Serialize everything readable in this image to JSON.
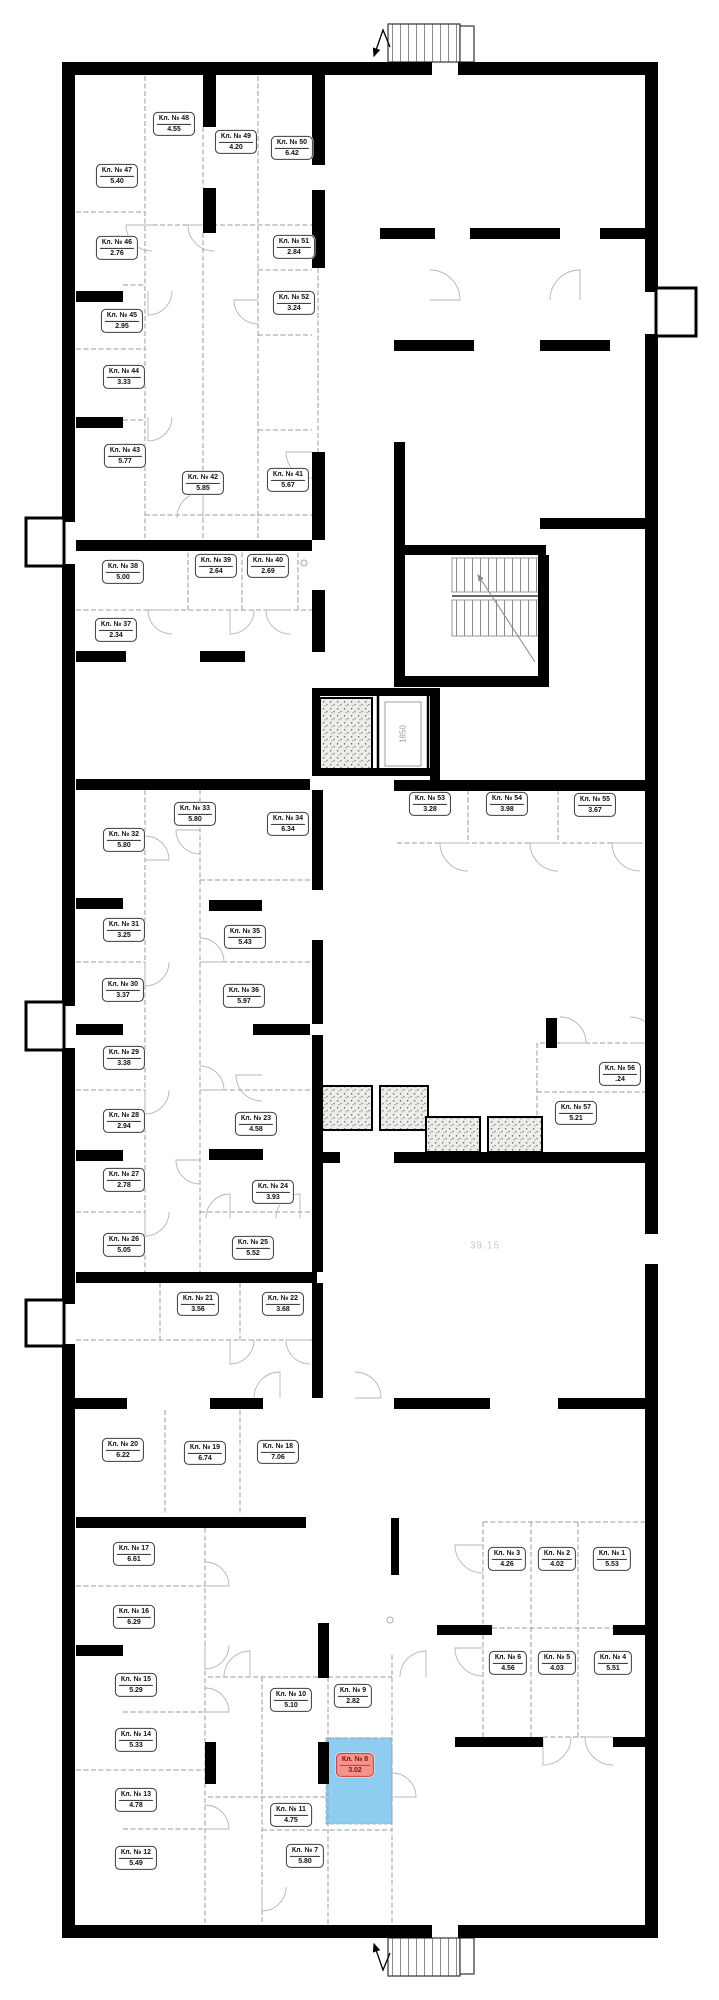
{
  "plan": {
    "wall_color": "#000000",
    "partition_color": "#9b9b9b",
    "highlight": {
      "room_fill": "#8ecdf0",
      "label_bg": "#f4928d",
      "label_border": "#cf3a31",
      "label_text": "#821313",
      "rect": [
        326,
        1738,
        66,
        86
      ]
    },
    "annotations": {
      "area_total": "39.15",
      "elevator_size": "1850"
    }
  },
  "rooms": [
    {
      "num": 1,
      "label": "Кл. № 1",
      "area": "5.53",
      "x": 612,
      "y": 1559,
      "highlighted": false
    },
    {
      "num": 2,
      "label": "Кл. № 2",
      "area": "4.02",
      "x": 557,
      "y": 1559,
      "highlighted": false
    },
    {
      "num": 3,
      "label": "Кл. № 3",
      "area": "4.26",
      "x": 507,
      "y": 1559,
      "highlighted": false
    },
    {
      "num": 4,
      "label": "Кл. № 4",
      "area": "5.51",
      "x": 613,
      "y": 1663,
      "highlighted": false
    },
    {
      "num": 5,
      "label": "Кл. № 5",
      "area": "4.03",
      "x": 557,
      "y": 1663,
      "highlighted": false
    },
    {
      "num": 6,
      "label": "Кл. № 6",
      "area": "4.56",
      "x": 508,
      "y": 1663,
      "highlighted": false
    },
    {
      "num": 7,
      "label": "Кл. № 7",
      "area": "5.80",
      "x": 305,
      "y": 1856,
      "highlighted": false
    },
    {
      "num": 8,
      "label": "Кл. № 8",
      "area": "3.02",
      "x": 355,
      "y": 1765,
      "highlighted": true
    },
    {
      "num": 9,
      "label": "Кл. № 9",
      "area": "2.82",
      "x": 353,
      "y": 1696,
      "highlighted": false
    },
    {
      "num": 10,
      "label": "Кл. № 10",
      "area": "5.10",
      "x": 291,
      "y": 1700,
      "highlighted": false
    },
    {
      "num": 11,
      "label": "Кл. № 11",
      "area": "4.75",
      "x": 291,
      "y": 1815,
      "highlighted": false
    },
    {
      "num": 12,
      "label": "Кл. № 12",
      "area": "5.49",
      "x": 136,
      "y": 1858,
      "highlighted": false
    },
    {
      "num": 13,
      "label": "Кл. № 13",
      "area": "4.78",
      "x": 136,
      "y": 1800,
      "highlighted": false
    },
    {
      "num": 14,
      "label": "Кл. № 14",
      "area": "5.33",
      "x": 136,
      "y": 1740,
      "highlighted": false
    },
    {
      "num": 15,
      "label": "Кл. № 15",
      "area": "5.29",
      "x": 136,
      "y": 1685,
      "highlighted": false
    },
    {
      "num": 16,
      "label": "Кл. № 16",
      "area": "6.29",
      "x": 134,
      "y": 1617,
      "highlighted": false
    },
    {
      "num": 17,
      "label": "Кл. № 17",
      "area": "6.61",
      "x": 134,
      "y": 1554,
      "highlighted": false
    },
    {
      "num": 18,
      "label": "Кл. № 18",
      "area": "7.06",
      "x": 278,
      "y": 1452,
      "highlighted": false
    },
    {
      "num": 19,
      "label": "Кл. № 19",
      "area": "6.74",
      "x": 205,
      "y": 1453,
      "highlighted": false
    },
    {
      "num": 20,
      "label": "Кл. № 20",
      "area": "6.22",
      "x": 123,
      "y": 1450,
      "highlighted": false
    },
    {
      "num": 21,
      "label": "Кл. № 21",
      "area": "3.56",
      "x": 198,
      "y": 1304,
      "highlighted": false
    },
    {
      "num": 22,
      "label": "Кл. № 22",
      "area": "3.68",
      "x": 283,
      "y": 1304,
      "highlighted": false
    },
    {
      "num": 23,
      "label": "Кл. № 23",
      "area": "4.58",
      "x": 256,
      "y": 1124,
      "highlighted": false
    },
    {
      "num": 24,
      "label": "Кл. № 24",
      "area": "3.93",
      "x": 273,
      "y": 1192,
      "highlighted": false
    },
    {
      "num": 25,
      "label": "Кл. № 25",
      "area": "5.52",
      "x": 253,
      "y": 1248,
      "highlighted": false
    },
    {
      "num": 26,
      "label": "Кл. № 26",
      "area": "5.05",
      "x": 124,
      "y": 1245,
      "highlighted": false
    },
    {
      "num": 27,
      "label": "Кл. № 27",
      "area": "2.78",
      "x": 124,
      "y": 1180,
      "highlighted": false
    },
    {
      "num": 28,
      "label": "Кл. № 28",
      "area": "2.94",
      "x": 124,
      "y": 1121,
      "highlighted": false
    },
    {
      "num": 29,
      "label": "Кл. № 29",
      "area": "3.38",
      "x": 124,
      "y": 1058,
      "highlighted": false
    },
    {
      "num": 30,
      "label": "Кл. № 30",
      "area": "3.37",
      "x": 123,
      "y": 990,
      "highlighted": false
    },
    {
      "num": 31,
      "label": "Кл. № 31",
      "area": "3.25",
      "x": 124,
      "y": 930,
      "highlighted": false
    },
    {
      "num": 32,
      "label": "Кл. № 32",
      "area": "5.80",
      "x": 124,
      "y": 840,
      "highlighted": false
    },
    {
      "num": 33,
      "label": "Кл. № 33",
      "area": "5.80",
      "x": 195,
      "y": 814,
      "highlighted": false
    },
    {
      "num": 34,
      "label": "Кл. № 34",
      "area": "6.34",
      "x": 288,
      "y": 824,
      "highlighted": false
    },
    {
      "num": 35,
      "label": "Кл. № 35",
      "area": "5.43",
      "x": 245,
      "y": 937,
      "highlighted": false
    },
    {
      "num": 36,
      "label": "Кл. № 36",
      "area": "5.97",
      "x": 244,
      "y": 996,
      "highlighted": false
    },
    {
      "num": 37,
      "label": "Кл. № 37",
      "area": "2.34",
      "x": 116,
      "y": 630,
      "highlighted": false
    },
    {
      "num": 38,
      "label": "Кл. № 38",
      "area": "5.00",
      "x": 123,
      "y": 572,
      "highlighted": false
    },
    {
      "num": 39,
      "label": "Кл. № 39",
      "area": "2.64",
      "x": 216,
      "y": 566,
      "highlighted": false
    },
    {
      "num": 40,
      "label": "Кл. № 40",
      "area": "2.69",
      "x": 268,
      "y": 566,
      "highlighted": false
    },
    {
      "num": 41,
      "label": "Кл. № 41",
      "area": "5.67",
      "x": 288,
      "y": 480,
      "highlighted": false
    },
    {
      "num": 42,
      "label": "Кл. № 42",
      "area": "5.85",
      "x": 203,
      "y": 483,
      "highlighted": false
    },
    {
      "num": 43,
      "label": "Кл. № 43",
      "area": "5.77",
      "x": 125,
      "y": 456,
      "highlighted": false
    },
    {
      "num": 44,
      "label": "Кл. № 44",
      "area": "3.33",
      "x": 124,
      "y": 377,
      "highlighted": false
    },
    {
      "num": 45,
      "label": "Кл. № 45",
      "area": "2.95",
      "x": 122,
      "y": 321,
      "highlighted": false
    },
    {
      "num": 46,
      "label": "Кл. № 46",
      "area": "2.76",
      "x": 117,
      "y": 248,
      "highlighted": false
    },
    {
      "num": 47,
      "label": "Кл. № 47",
      "area": "5.40",
      "x": 117,
      "y": 176,
      "highlighted": false
    },
    {
      "num": 48,
      "label": "Кл. № 48",
      "area": "4.55",
      "x": 174,
      "y": 124,
      "highlighted": false
    },
    {
      "num": 49,
      "label": "Кл. № 49",
      "area": "4.20",
      "x": 236,
      "y": 142,
      "highlighted": false
    },
    {
      "num": 50,
      "label": "Кл. № 50",
      "area": "6.42",
      "x": 292,
      "y": 148,
      "highlighted": false
    },
    {
      "num": 51,
      "label": "Кл. № 51",
      "area": "2.84",
      "x": 294,
      "y": 247,
      "highlighted": false
    },
    {
      "num": 52,
      "label": "Кл. № 52",
      "area": "3.24",
      "x": 294,
      "y": 303,
      "highlighted": false
    },
    {
      "num": 53,
      "label": "Кл. № 53",
      "area": "3.28",
      "x": 430,
      "y": 804,
      "highlighted": false
    },
    {
      "num": 54,
      "label": "Кл. № 54",
      "area": "3.98",
      "x": 507,
      "y": 804,
      "highlighted": false
    },
    {
      "num": 55,
      "label": "Кл. № 55",
      "area": "3.67",
      "x": 595,
      "y": 805,
      "highlighted": false
    },
    {
      "num": 56,
      "label": "Кл. № 56",
      "area": ".24",
      "x": 620,
      "y": 1074,
      "highlighted": false
    },
    {
      "num": 57,
      "label": "Кл. № 57",
      "area": "5.21",
      "x": 576,
      "y": 1113,
      "highlighted": false
    }
  ]
}
